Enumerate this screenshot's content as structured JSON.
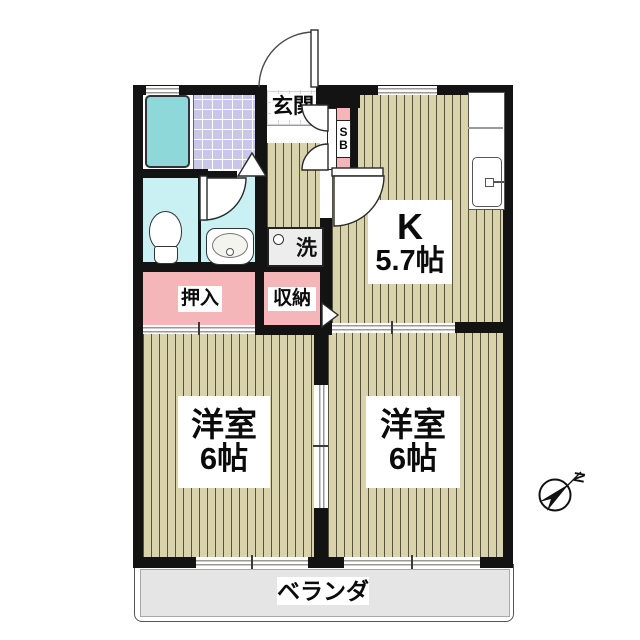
{
  "floorplan": {
    "rooms": [
      {
        "key": "kitchen",
        "name": "K",
        "size": "5.7帖"
      },
      {
        "key": "western_room_left",
        "name": "洋室",
        "size": "6帖"
      },
      {
        "key": "western_room_right",
        "name": "洋室",
        "size": "6帖"
      }
    ],
    "labels": {
      "entrance": "玄関",
      "closet": "押入",
      "storage": "収納",
      "laundry": "洗",
      "shoe_box_s": "S",
      "shoe_box_b": "B",
      "veranda": "ベランダ",
      "north": "N"
    },
    "colors": {
      "wall": "#131313",
      "wood_floor": "#d9d3ab",
      "closet_pink": "#f5b6ba",
      "wet_area_cyan": "#c9f0f2",
      "bath_tile": "#c9c6ea",
      "bathtub": "#8ed8da",
      "laundry_gray": "#ededed",
      "veranda_gray": "#e5e5e5"
    }
  }
}
